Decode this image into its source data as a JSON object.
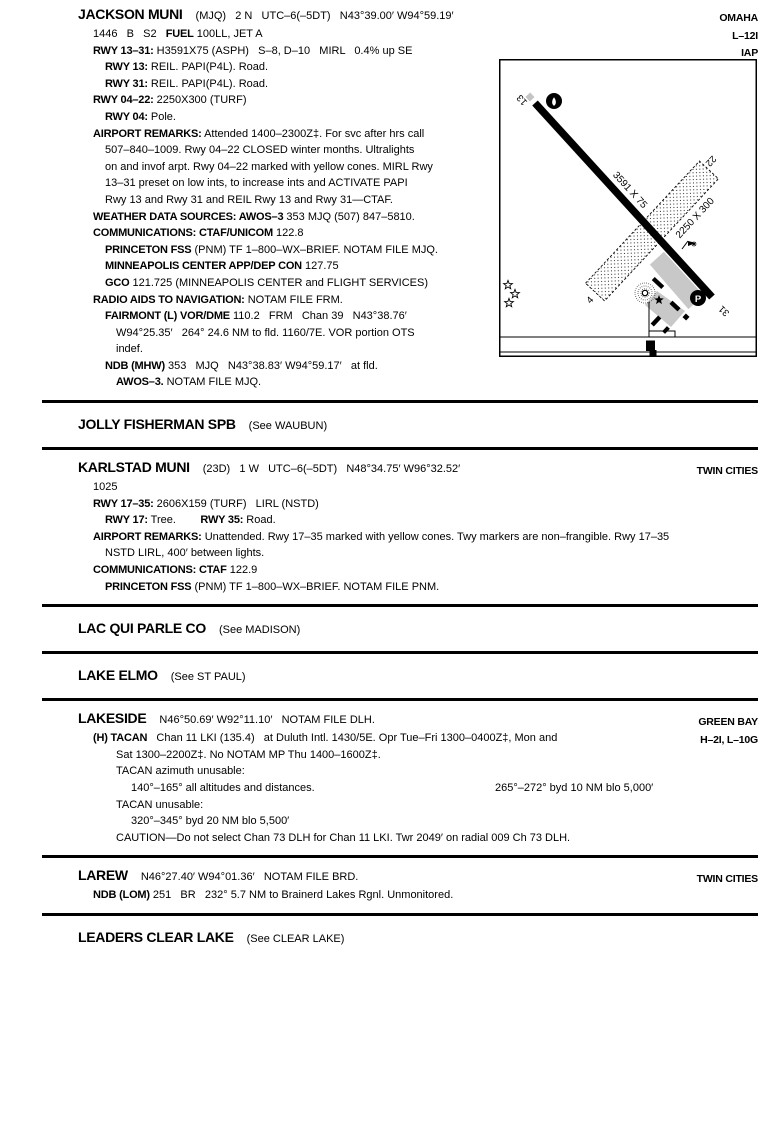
{
  "page": {
    "sections": [
      {
        "id": "jackson-muni",
        "name": "JACKSON MUNI",
        "suffix": "(MJQ)   2 N   UTC–6(–5DT)   N43°39.00′ W94°59.19′",
        "right": "OMAHA",
        "lines": [
          {
            "i": 1,
            "right": "L–12I",
            "seg": [
              {
                "b": false,
                "t": "1446   B   S2   "
              },
              {
                "b": true,
                "t": "FUEL"
              },
              {
                "b": false,
                "t": " 100LL, JET A"
              }
            ]
          },
          {
            "i": 1,
            "right": "IAP",
            "seg": [
              {
                "b": true,
                "t": "RWY 13–31:"
              },
              {
                "b": false,
                "t": " H3591X75 (ASPH)   S–8, D–10   MIRL   0.4% up SE"
              }
            ]
          },
          {
            "i": 2,
            "seg": [
              {
                "b": true,
                "t": "RWY 13:"
              },
              {
                "b": false,
                "t": " REIL. PAPI(P4L). Road."
              }
            ]
          },
          {
            "i": 2,
            "seg": [
              {
                "b": true,
                "t": "RWY 31:"
              },
              {
                "b": false,
                "t": " REIL. PAPI(P4L). Road."
              }
            ]
          },
          {
            "i": 1,
            "seg": [
              {
                "b": true,
                "t": "RWY 04–22:"
              },
              {
                "b": false,
                "t": " 2250X300 (TURF)"
              }
            ]
          },
          {
            "i": 2,
            "seg": [
              {
                "b": true,
                "t": "RWY 04:"
              },
              {
                "b": false,
                "t": " Pole."
              }
            ]
          },
          {
            "i": 1,
            "seg": [
              {
                "b": true,
                "t": "AIRPORT REMARKS:"
              },
              {
                "b": false,
                "t": " Attended 1400–2300Z‡. For svc after hrs call"
              }
            ]
          },
          {
            "i": 2,
            "seg": [
              {
                "b": false,
                "t": "507–840–1009. Rwy 04–22 CLOSED winter months. Ultralights"
              }
            ]
          },
          {
            "i": 2,
            "seg": [
              {
                "b": false,
                "t": "on and invof arpt. Rwy 04–22 marked with yellow cones. MIRL Rwy"
              }
            ]
          },
          {
            "i": 2,
            "seg": [
              {
                "b": false,
                "t": "13–31 preset on low ints, to increase ints and ACTIVATE PAPI"
              }
            ]
          },
          {
            "i": 2,
            "seg": [
              {
                "b": false,
                "t": "Rwy 13 and Rwy 31 and REIL Rwy 13 and Rwy 31—CTAF."
              }
            ]
          },
          {
            "i": 1,
            "seg": [
              {
                "b": true,
                "t": "WEATHER DATA SOURCES: AWOS–3"
              },
              {
                "b": false,
                "t": " 353 MJQ (507) 847–5810."
              }
            ]
          },
          {
            "i": 1,
            "seg": [
              {
                "b": true,
                "t": "COMMUNICATIONS: CTAF/UNICOM"
              },
              {
                "b": false,
                "t": " 122.8"
              }
            ]
          },
          {
            "i": 2,
            "seg": [
              {
                "b": true,
                "t": "PRINCETON FSS"
              },
              {
                "b": false,
                "t": " (PNM) TF 1–800–WX–BRIEF. NOTAM FILE MJQ."
              }
            ]
          },
          {
            "i": 2,
            "seg": [
              {
                "b": true,
                "t": "MINNEAPOLIS CENTER APP/DEP CON"
              },
              {
                "b": false,
                "t": " 127.75"
              }
            ]
          },
          {
            "i": 2,
            "seg": [
              {
                "b": true,
                "t": "GCO"
              },
              {
                "b": false,
                "t": " 121.725 (MINNEAPOLIS CENTER and FLIGHT SERVICES)"
              }
            ]
          },
          {
            "i": 1,
            "seg": [
              {
                "b": true,
                "t": "RADIO AIDS TO NAVIGATION:"
              },
              {
                "b": false,
                "t": " NOTAM FILE FRM."
              }
            ]
          },
          {
            "i": 2,
            "seg": [
              {
                "b": true,
                "t": "FAIRMONT (L) VOR/DME"
              },
              {
                "b": false,
                "t": " 110.2   FRM   Chan 39   N43°38.76′"
              }
            ]
          },
          {
            "i": 3,
            "seg": [
              {
                "b": false,
                "t": "W94°25.35′   264° 24.6 NM to fld. 1160/7E. VOR portion OTS"
              }
            ]
          },
          {
            "i": 3,
            "seg": [
              {
                "b": false,
                "t": "indef."
              }
            ]
          },
          {
            "i": 2,
            "seg": [
              {
                "b": true,
                "t": "NDB (MHW)"
              },
              {
                "b": false,
                "t": " 353   MJQ   N43°38.83′ W94°59.17′   at fld."
              }
            ]
          },
          {
            "i": 3,
            "seg": [
              {
                "b": true,
                "t": "AWOS–3."
              },
              {
                "b": false,
                "t": " NOTAM FILE MJQ."
              }
            ]
          }
        ]
      },
      {
        "id": "jolly-fisherman-spb",
        "see": true,
        "name": "JOLLY FISHERMAN SPB",
        "suffix": "(See WAUBUN)",
        "lines": []
      },
      {
        "id": "karlstad-muni",
        "name": "KARLSTAD MUNI",
        "suffix": "(23D)   1 W   UTC–6(–5DT)   N48°34.75′ W96°32.52′",
        "right": "TWIN CITIES",
        "lines": [
          {
            "i": 1,
            "seg": [
              {
                "b": false,
                "t": "1025"
              }
            ]
          },
          {
            "i": 1,
            "seg": [
              {
                "b": true,
                "t": "RWY 17–35:"
              },
              {
                "b": false,
                "t": " 2606X159 (TURF)   LIRL (NSTD)"
              }
            ]
          },
          {
            "i": 2,
            "seg": [
              {
                "b": true,
                "t": "RWY 17:"
              },
              {
                "b": false,
                "t": " Tree.        "
              },
              {
                "b": true,
                "t": "RWY 35:"
              },
              {
                "b": false,
                "t": " Road."
              }
            ]
          },
          {
            "i": 1,
            "seg": [
              {
                "b": true,
                "t": "AIRPORT REMARKS:"
              },
              {
                "b": false,
                "t": " Unattended. Rwy 17–35 marked with yellow cones. Twy markers are non–frangible. Rwy 17–35"
              }
            ]
          },
          {
            "i": 2,
            "seg": [
              {
                "b": false,
                "t": "NSTD LIRL, 400′ between lights."
              }
            ]
          },
          {
            "i": 1,
            "seg": [
              {
                "b": true,
                "t": "COMMUNICATIONS: CTAF"
              },
              {
                "b": false,
                "t": " 122.9"
              }
            ]
          },
          {
            "i": 2,
            "seg": [
              {
                "b": true,
                "t": "PRINCETON FSS"
              },
              {
                "b": false,
                "t": " (PNM) TF 1–800–WX–BRIEF. NOTAM FILE PNM."
              }
            ]
          }
        ]
      },
      {
        "id": "lac-qui-parle-co",
        "see": true,
        "name": "LAC QUI PARLE CO",
        "suffix": "(See MADISON)",
        "lines": []
      },
      {
        "id": "lake-elmo",
        "see": true,
        "name": "LAKE ELMO",
        "suffix": "(See ST PAUL)",
        "lines": []
      },
      {
        "id": "lakeside",
        "name": "LAKESIDE",
        "suffix": "N46°50.69′ W92°11.10′   NOTAM FILE DLH.",
        "right": "GREEN BAY",
        "lines": [
          {
            "i": 1,
            "right": "H–2I, L–10G",
            "seg": [
              {
                "b": true,
                "t": "(H) TACAN"
              },
              {
                "b": false,
                "t": "   Chan 11 LKI (135.4)   at Duluth Intl. 1430/5E. Opr Tue–Fri 1300–0400Z‡, Mon and"
              }
            ]
          },
          {
            "i": 3,
            "seg": [
              {
                "b": false,
                "t": "Sat 1300–2200Z‡. No NOTAM MP Thu 1400–1600Z‡."
              }
            ]
          },
          {
            "i": 3,
            "seg": [
              {
                "b": false,
                "t": "TACAN azimuth unusable:"
              }
            ]
          },
          {
            "i": 4,
            "mid_right": "265°–272° byd 10 NM blo 5,000′",
            "seg": [
              {
                "b": false,
                "t": "140°–165° all altitudes and distances."
              }
            ]
          },
          {
            "i": 3,
            "seg": [
              {
                "b": false,
                "t": "TACAN unusable:"
              }
            ]
          },
          {
            "i": 4,
            "seg": [
              {
                "b": false,
                "t": "320°–345° byd 20 NM blo 5,500′"
              }
            ]
          },
          {
            "i": 3,
            "seg": [
              {
                "b": false,
                "t": "CAUTION—Do not select Chan 73 DLH for Chan 11 LKI. Twr 2049′ on radial 009 Ch 73 DLH."
              }
            ]
          }
        ]
      },
      {
        "id": "larew",
        "name": "LAREW",
        "suffix": "N46°27.40′ W94°01.36′   NOTAM FILE BRD.",
        "right": "TWIN CITIES",
        "lines": [
          {
            "i": 1,
            "seg": [
              {
                "b": true,
                "t": "NDB (LOM)"
              },
              {
                "b": false,
                "t": " 251   BR   232° 5.7 NM to Brainerd Lakes Rgnl. Unmonitored."
              }
            ]
          }
        ]
      },
      {
        "id": "leaders-clear-lake",
        "see": true,
        "name": "LEADERS CLEAR LAKE",
        "suffix": "(See CLEAR LAKE)",
        "lines": []
      }
    ]
  },
  "diagram": {
    "labels": {
      "rwy13": "13",
      "rwy31": "31",
      "rwy22": "22",
      "rwy04": "4",
      "paved_dim": "3591 X 75",
      "turf_dim": "2250 X 300",
      "parking": "P"
    },
    "colors": {
      "apron": "#c8c8c8",
      "runway": "#000000",
      "background": "#ffffff"
    }
  }
}
